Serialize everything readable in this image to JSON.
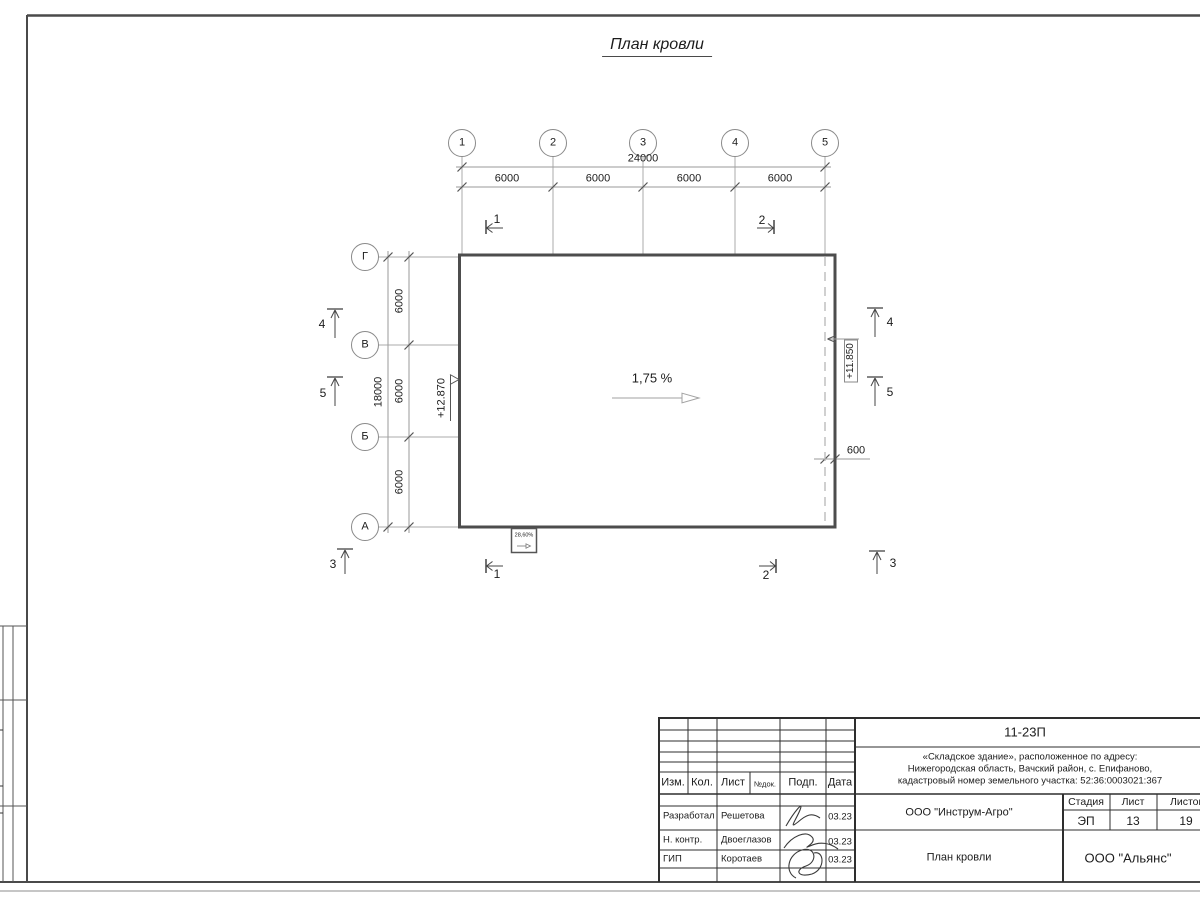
{
  "sheet": {
    "title": "План кровли",
    "slope_label": "1,75 %",
    "detail_slope_label": "28,60%",
    "elevation_left": "+12.870",
    "elevation_right": "+11.850",
    "overhang_dim": "600"
  },
  "grid": {
    "col_axes": [
      "1",
      "2",
      "3",
      "4",
      "5"
    ],
    "row_axes": [
      "Г",
      "В",
      "Б",
      "А"
    ],
    "top_total": "24000",
    "top_spans": [
      "6000",
      "6000",
      "6000",
      "6000"
    ],
    "left_total": "18000",
    "left_spans": [
      "6000",
      "6000",
      "6000"
    ]
  },
  "sections": {
    "cut_1": "1",
    "cut_2": "2",
    "view_3": "3",
    "view_4": "4",
    "view_5": "5"
  },
  "titleblock": {
    "doc_number": "11-23П",
    "project_line1": "«Складское здание», расположенное по адресу:",
    "project_line2": "Нижегородская область, Вачский район, с. Епифаново,",
    "project_line3": "кадастровый номер земельного участка: 52:36:0003021:367",
    "header_cols": {
      "izm": "Изм.",
      "kol": "Кол.",
      "list": "Лист",
      "ndok": "№док.",
      "podp": "Подп.",
      "data": "Дата"
    },
    "rows": [
      {
        "role": "Разработал",
        "name": "Решетова",
        "date": "03.23"
      },
      {
        "role": "Н. контр.",
        "name": "Двоеглазов",
        "date": "03.23"
      },
      {
        "role": "ГИП",
        "name": "Коротаев",
        "date": "03.23"
      }
    ],
    "company": "ООО \"Инструм-Агро\"",
    "sheet_name": "План кровли",
    "stage_label": "Стадия",
    "stage": "ЭП",
    "sheet_label": "Лист",
    "sheet_no": "13",
    "sheets_label": "Листов",
    "sheets_total": "19",
    "contractor": "ООО \"Альянс\""
  }
}
